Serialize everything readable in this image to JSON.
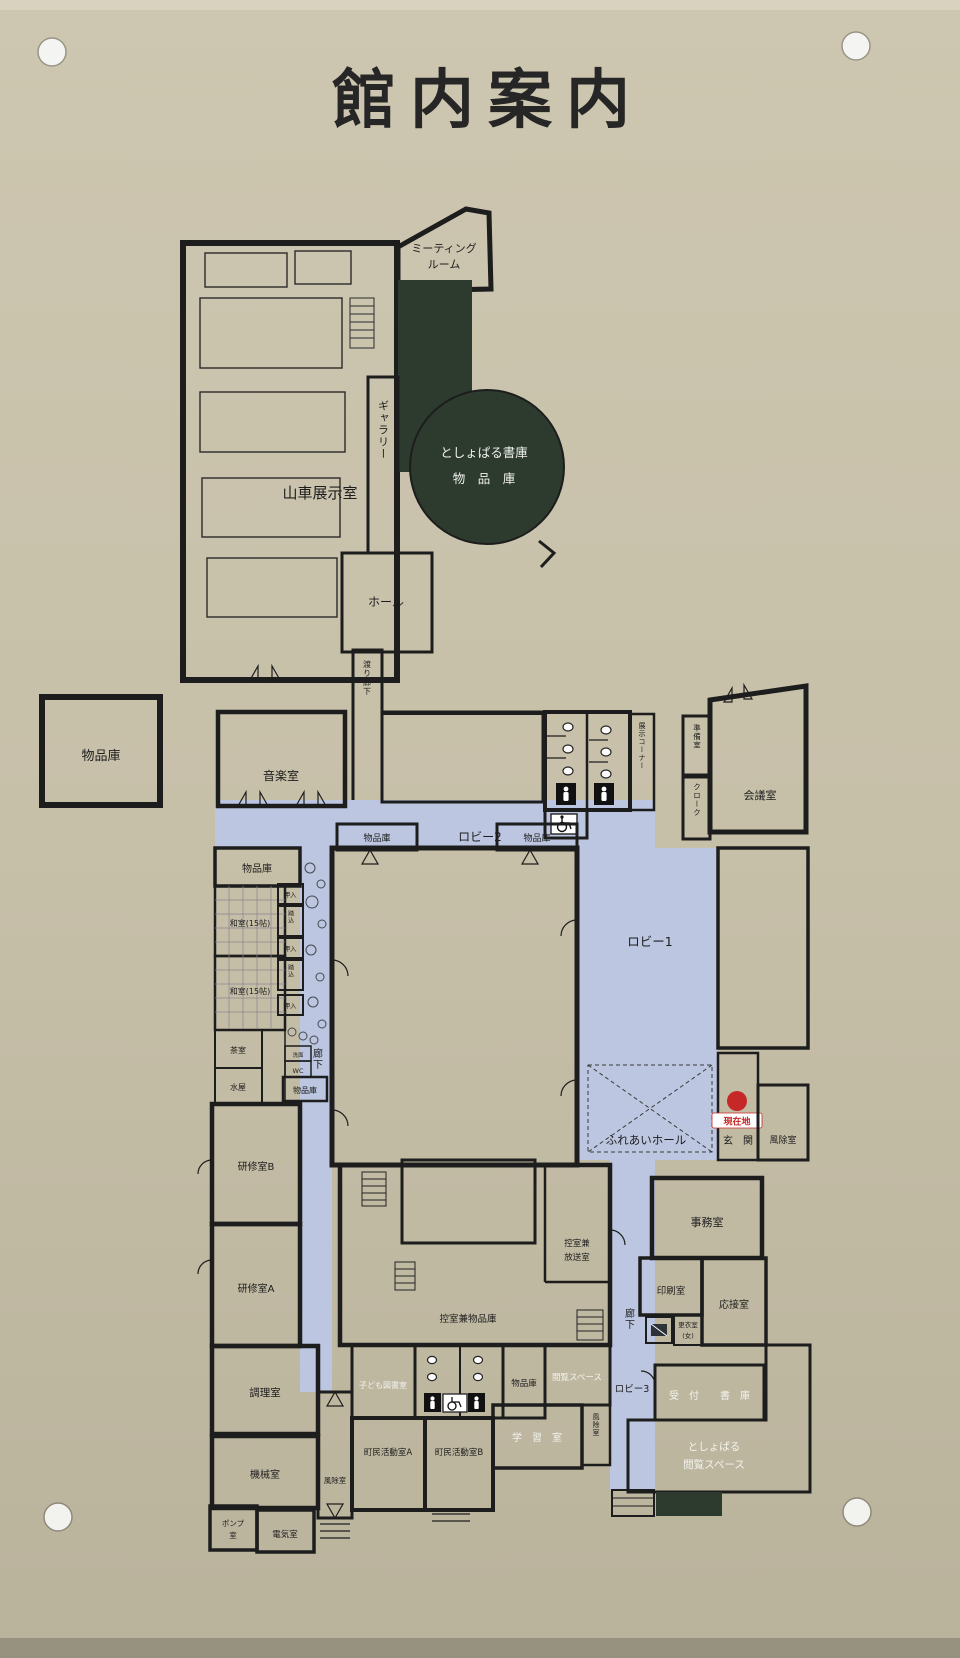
{
  "sign": {
    "title": "館内案内"
  },
  "palette": {
    "board": "#c7c0a9",
    "room_mint": "#a9e2cc",
    "room_pink": "#f2dbe3",
    "corridor_blue": "#bcc6e0",
    "dark_green": "#2d3b2f",
    "wall": "#1d1d1d",
    "marker_red": "#c62828",
    "label_white": "#f3f3ee"
  },
  "current_location": {
    "label": "現在地"
  },
  "labels": {
    "dashi_tenjishitsu": "山車展示室",
    "meeting_room": [
      "ミーティング",
      "ルーム"
    ],
    "gallery": "ギャラリー",
    "toshoparu_shoko": "としょぱる書庫",
    "buppinko_wide": "物　品　庫",
    "hall": "ホール",
    "watari_roka": "渡り廊下",
    "buppinko": "物品庫",
    "ongakushitsu": "音楽室",
    "tenji_corner": "展示コーナー",
    "junbishitsu": "準備室",
    "cloak": "クローク",
    "kaigishitsu": "会議室",
    "lobby2": "ロビー2",
    "oshiire": "押入",
    "fumikomi": "踏込",
    "washitsu": "和室(15帖)",
    "chashitsu": "茶室",
    "mizuya": "水屋",
    "senmen": "洗面",
    "wc": "WC",
    "roka": "廊下",
    "kenshu_b": "研修室B",
    "kenshu_a": "研修室A",
    "chorishitsu": "調理室",
    "kikaishitsu": "機械室",
    "pump": [
      "ポンプ",
      "室"
    ],
    "denkishitsu": "電気室",
    "fujoshitsu": "風除室",
    "lobby1": "ロビー1",
    "fureai_hall": "ふれあいホール",
    "genkan": "玄　関",
    "jimushitsu": "事務室",
    "insatsushitsu": "印刷室",
    "osetsushitsu": "応接室",
    "koishitsu": [
      "更衣室",
      "(女)"
    ],
    "hikae_hoso": [
      "控室兼",
      "放送室"
    ],
    "hikae_buppinko": "控室兼物品庫",
    "kodomo_toshoshitsu": "子ども図書室",
    "etsuran_space": "閲覧スペース",
    "lobby3": "ロビー3",
    "uketsuke": "受　付",
    "shoko": "書　庫",
    "toshoparu_etsuran": [
      "としょぱる",
      "閲覧スペース"
    ],
    "chomin_a": "町民活動室A",
    "chomin_b": "町民活動室B",
    "gakushushitsu": "学　習　室"
  }
}
